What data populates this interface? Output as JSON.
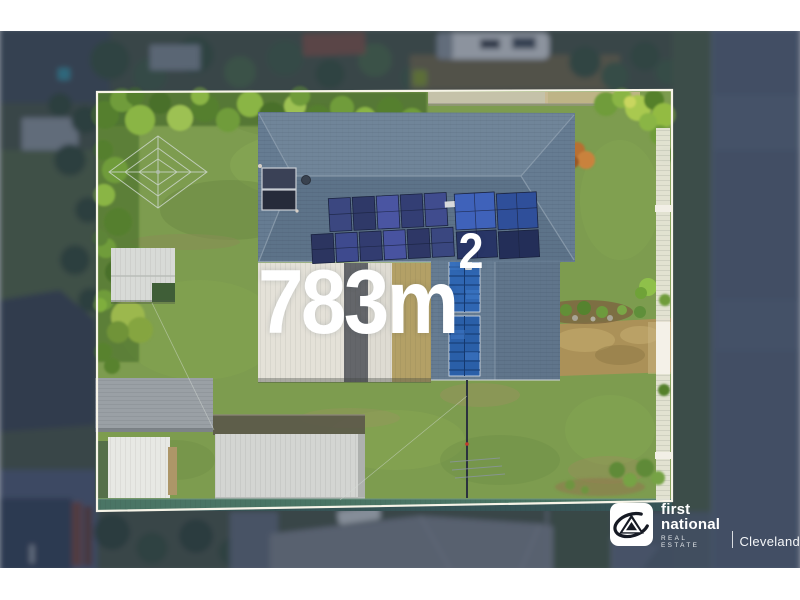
{
  "overlay": {
    "area_value": "783m",
    "area_superscript": "2",
    "area_label_display": "783m²"
  },
  "logo": {
    "brand_line1": "first",
    "brand_line2": "national",
    "tagline": "REAL ESTATE",
    "office": "Cleveland"
  },
  "scene": {
    "type": "aerial-drone-photograph",
    "features": [
      "property-boundary-outline",
      "house-tiled-roof",
      "solar-panel-arrays",
      "solar-hot-water-panel",
      "patio-roofs",
      "garden-sheds",
      "carport",
      "clothesline",
      "lawn",
      "driveway",
      "white-pool-fence",
      "teal-rear-fence",
      "palm-trees",
      "street-right",
      "street-bottom",
      "neighbour-roofs",
      "caravan"
    ]
  },
  "colors": {
    "boundary": "#f7f4e8",
    "dim": "rgba(30,44,68,0.45)",
    "lawn": "#7d9c4f",
    "roof": "#667c92",
    "solar": "#2a5fa8",
    "road": "#5e6b7f",
    "driveway": "#ab9158",
    "fenceWhite": "#eae7dc",
    "fenceTeal": "#4a7565",
    "shed": "#d3d5d2",
    "text": "#ffffff",
    "ink": "#161a24"
  }
}
